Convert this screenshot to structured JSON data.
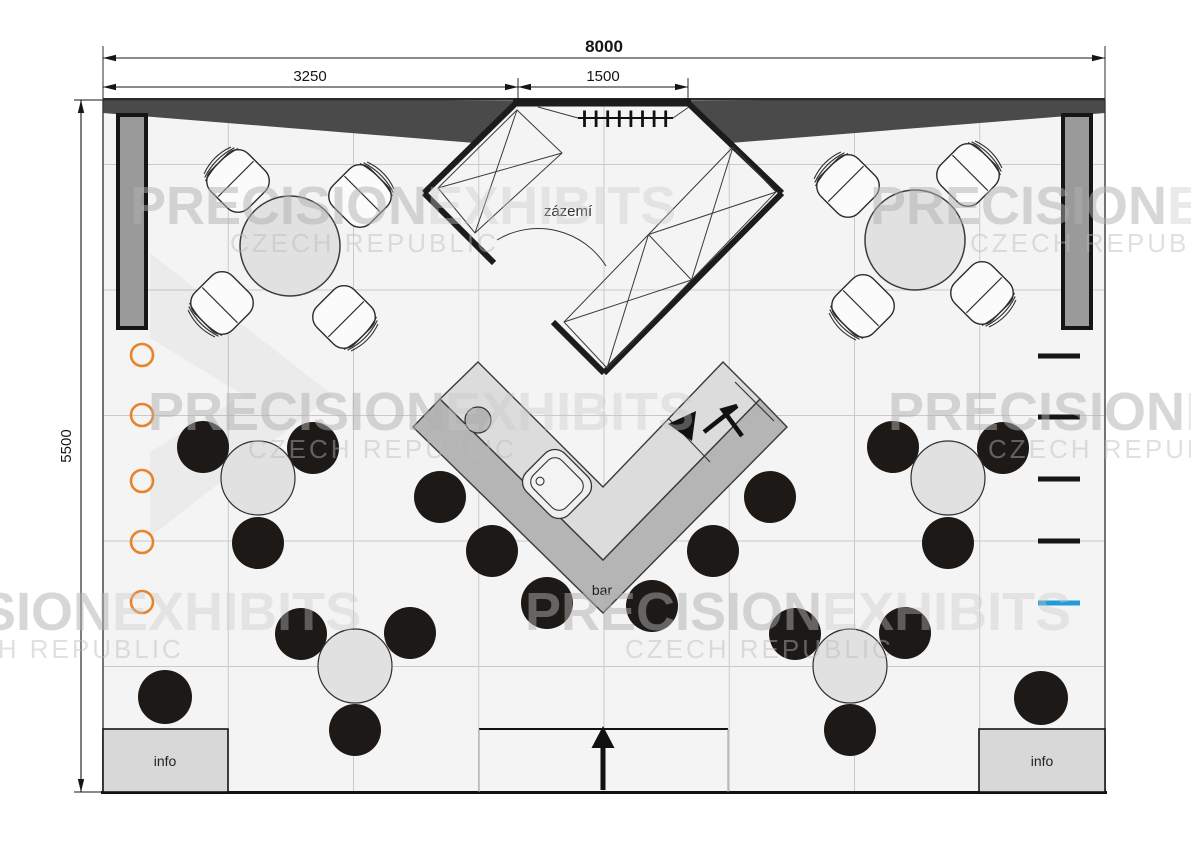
{
  "plan": {
    "dimensions": {
      "total_width": "8000",
      "left_span": "3250",
      "center_span": "1500",
      "total_depth": "5500"
    },
    "rooms": {
      "backroom_label": "zázemí",
      "bar_label": "bar"
    },
    "info_counters": {
      "left_label": "info",
      "right_label": "info"
    },
    "watermark": {
      "brand_bold": "PRECISION",
      "brand_light": "EXHIBITS",
      "subtitle": "CZECH REPUBLIC"
    },
    "colors": {
      "floor": "#f4f4f4",
      "fascia_dark": "#4a4a4a",
      "wall_black": "#1c1c1c",
      "panel_gray": "#9a9a9a",
      "counter_top": "#dcdcdc",
      "counter_front": "#b5b5b5",
      "table_fill": "#e1e1e1",
      "stool_black": "#1d1916",
      "accent_orange": "#e8832a",
      "accent_blue": "#1f9cd9",
      "info_fill": "#d8d8d8"
    }
  }
}
